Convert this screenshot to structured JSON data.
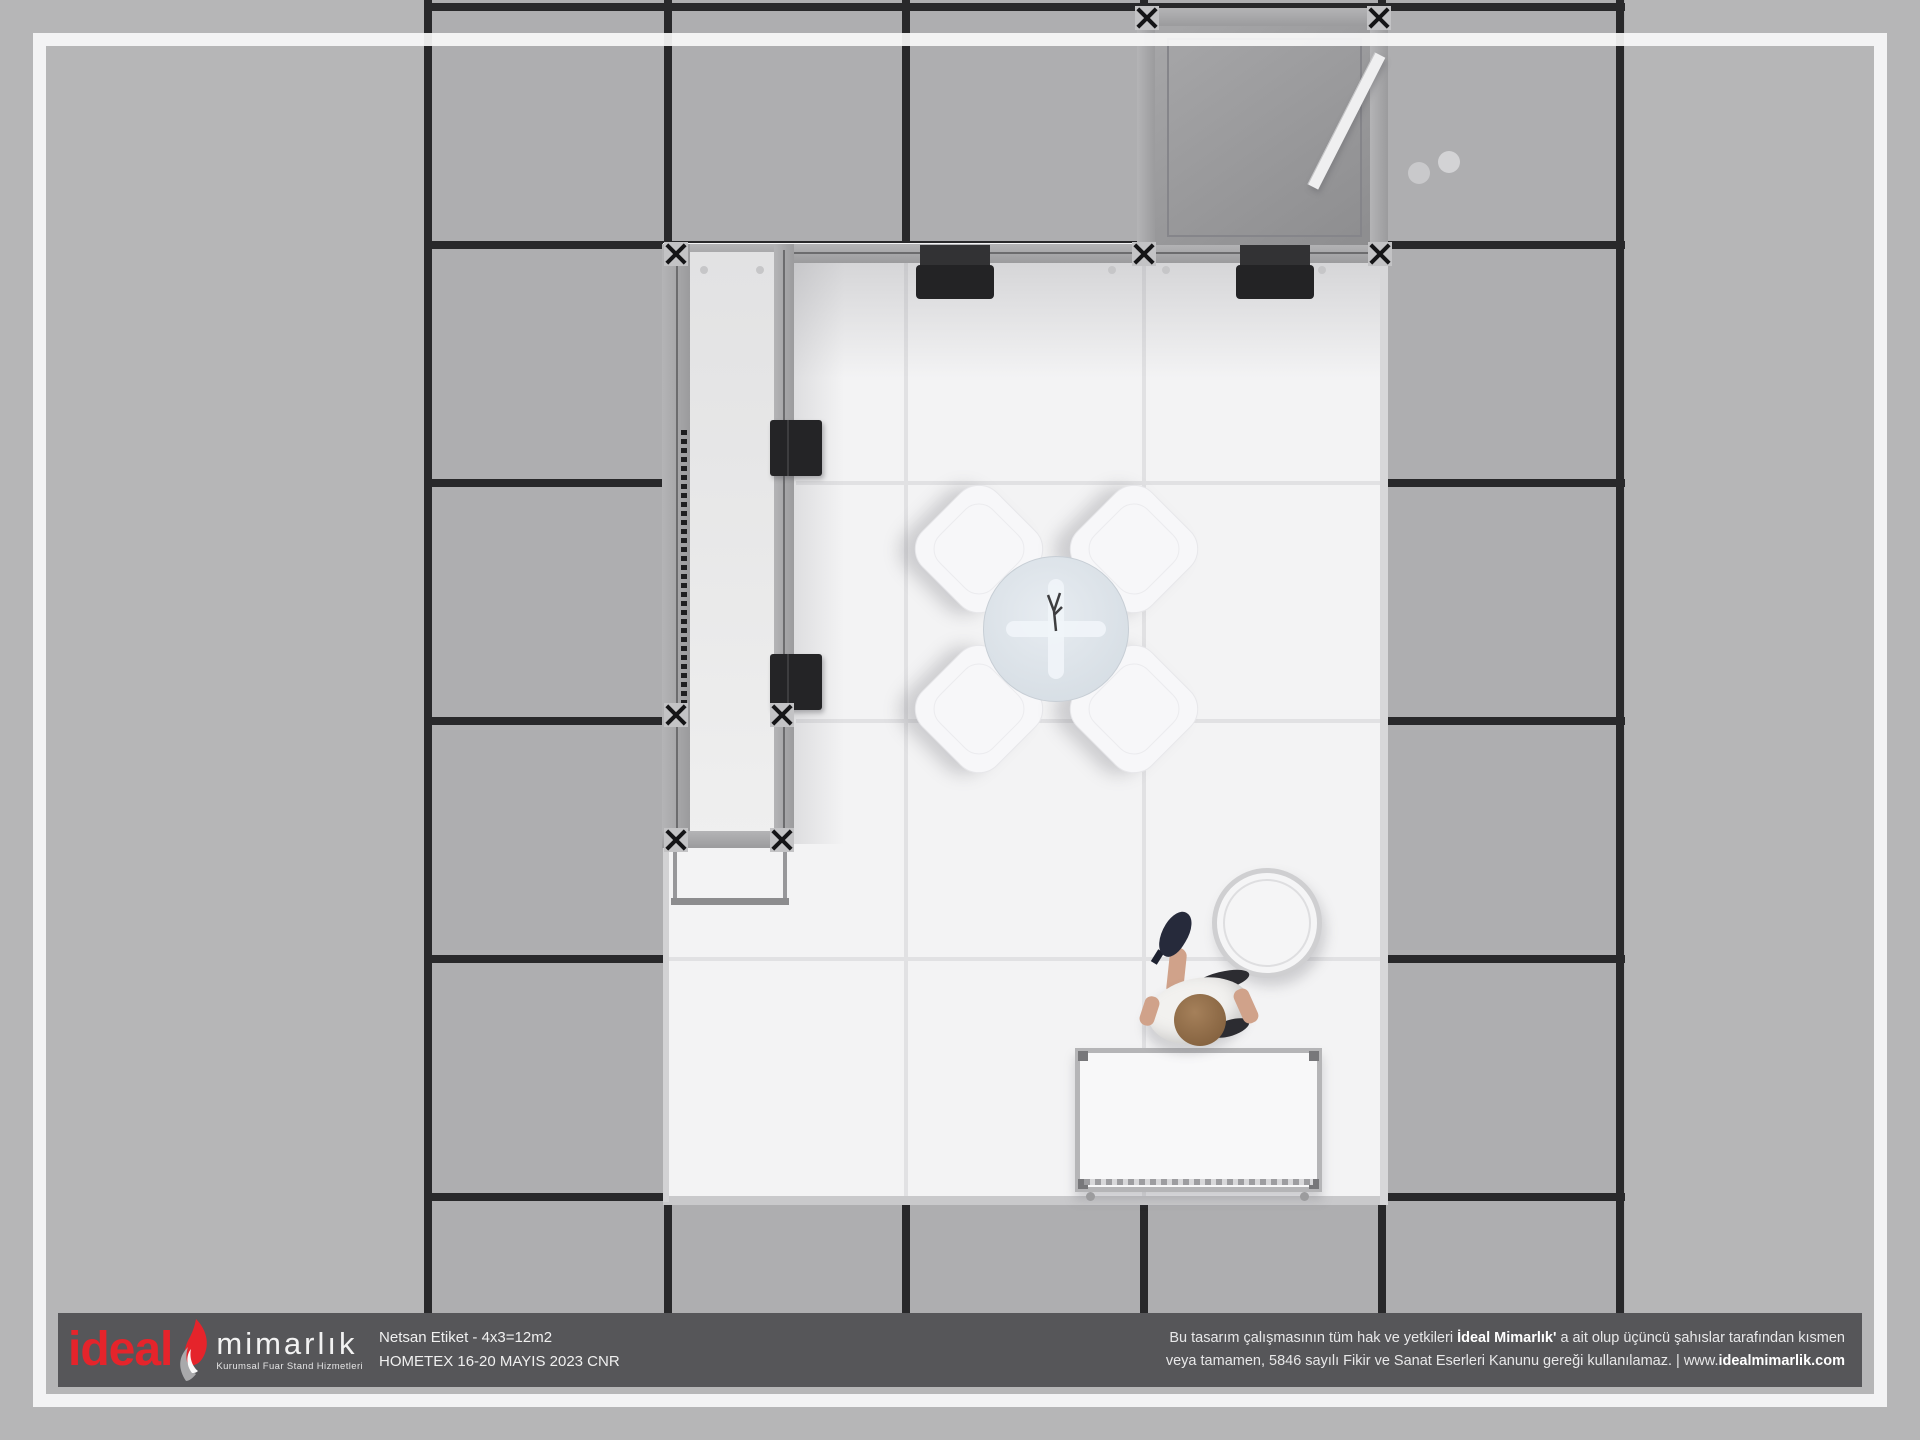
{
  "footer": {
    "logo": {
      "brand": "ideal",
      "brand2": "mimarlık",
      "tagline": "Kurumsal Fuar Stand Hizmetleri",
      "flame_icon": "flame-leaf-icon"
    },
    "project": {
      "line1": "Netsan Etiket - 4x3=12m2",
      "line2": "HOMETEX 16-20 MAYIS 2023 CNR"
    },
    "copyright": {
      "line1_pre": "Bu tasarım çalışmasının tüm hak ve yetkileri ",
      "line1_bold": "İdeal Mimarlık'",
      "line1_post": " a ait olup üçüncü şahıslar tarafından kısmen",
      "line2_pre": "veya tamamen, 5846 sayılı Fikir ve Sanat Eserleri Kanunu gereği kullanılamaz. | www.",
      "line2_bold": "idealmimarlik.com"
    }
  },
  "scene": {
    "chair_count": 4,
    "hanger_count": 7
  },
  "colors": {
    "accent_red": "#e5242b",
    "footer_bar": "#565659",
    "floor_outer": "#b6b6b7",
    "floor_tile": "#aeaeb0",
    "grid_line": "#28282a",
    "platform_white": "#f3f3f4",
    "aluminum": "#a5a5a7",
    "cabin_glass_dark": "#8e8e90",
    "fixture_black": "#232325",
    "hanger_pink": "#d49cb4",
    "table_glass": "#dbe2e8",
    "shirt_white": "#f2f1ef",
    "skin": "#d0a28a",
    "hair_brown": "#83603c",
    "shoe_navy": "#262a3b"
  }
}
